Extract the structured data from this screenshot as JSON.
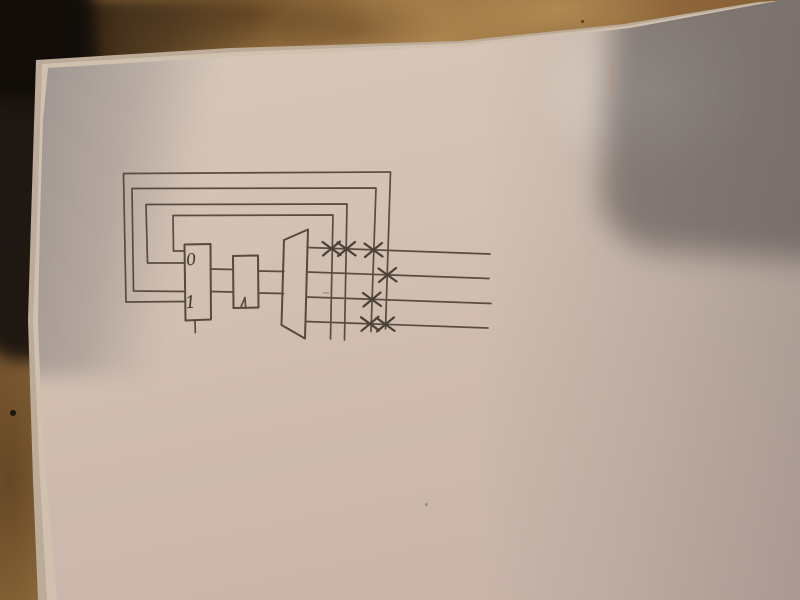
{
  "scene": {
    "setting": "photograph of a hand-drawn logic-circuit sketch on a blank sheet of paper lying on a wooden table",
    "paper": "white sheet on top of a small stack, dark object at top-left, soft camera shadow at top-right",
    "colors": {
      "ink": "#5a4c40",
      "paper": "#d3c1b3",
      "paper_shadow": "#8f8784",
      "wood": "#96713f",
      "dark_object": "#1f1711"
    }
  },
  "diagram": {
    "type": "hand-drawn digital logic sketch (mux, clocked register, demux, feedback crossbar)",
    "mux": {
      "label_top": "0",
      "label_bottom": "1"
    },
    "register": {
      "clock_marker": "^"
    },
    "demux": {
      "shape": "trapezoid",
      "outputs": 4
    },
    "crossbar": {
      "output_rows": 4,
      "feedback_columns": 4,
      "cross_marks": [
        {
          "row": 1,
          "col": 1
        },
        {
          "row": 1,
          "col": 2
        },
        {
          "row": 1,
          "col": 3
        },
        {
          "row": 2,
          "col": 4
        },
        {
          "row": 3,
          "col": 3
        },
        {
          "row": 4,
          "col": 3
        },
        {
          "row": 4,
          "col": 4
        }
      ]
    }
  }
}
